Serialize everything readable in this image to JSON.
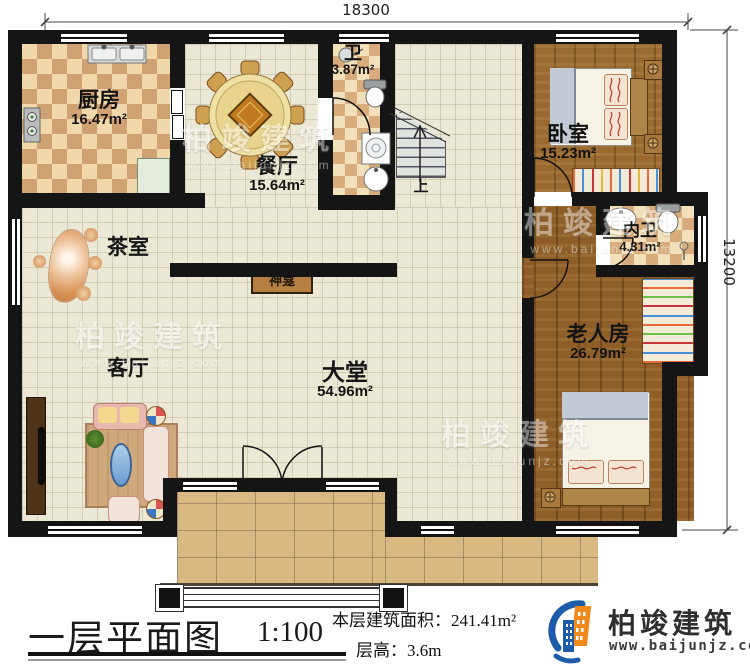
{
  "dimensions": {
    "top": "18300",
    "right": "13200"
  },
  "rooms": {
    "kitchen": {
      "name": "厨房",
      "area": "16.47m²"
    },
    "dining": {
      "name": "餐厅",
      "area": "15.64m²"
    },
    "bath": {
      "name": "卫",
      "area": "3.87m²"
    },
    "bedroom": {
      "name": "卧室",
      "area": "15.23m²"
    },
    "ensuite": {
      "name": "内卫",
      "area": "4.31m²"
    },
    "tea": {
      "name": "茶室"
    },
    "shrine": {
      "name": "神龛"
    },
    "living": {
      "name": "客厅"
    },
    "hall": {
      "name": "大堂",
      "area": "54.96m²"
    },
    "elder": {
      "name": "老人房",
      "area": "26.79m²"
    },
    "stairs": {
      "up": "上"
    }
  },
  "footer": {
    "title": "一层平面图",
    "scale": "1:100",
    "area_label": "本层建筑面积：",
    "area_value": "241.41m²",
    "floor_height_label": "层高：",
    "floor_height_value": "3.6m"
  },
  "brand": {
    "company": "柏竣建筑",
    "website": "www.baijunjz.com"
  },
  "watermark": {
    "text": "柏竣建筑",
    "website": "www.baijunjz.com"
  },
  "colors": {
    "wall": "#151515",
    "wood": "#9a6a31",
    "tile": "#ebe8d6",
    "porch": "#d8b982",
    "accent_blue": "#1d5ca8",
    "accent_orange": "#f08a1d"
  }
}
